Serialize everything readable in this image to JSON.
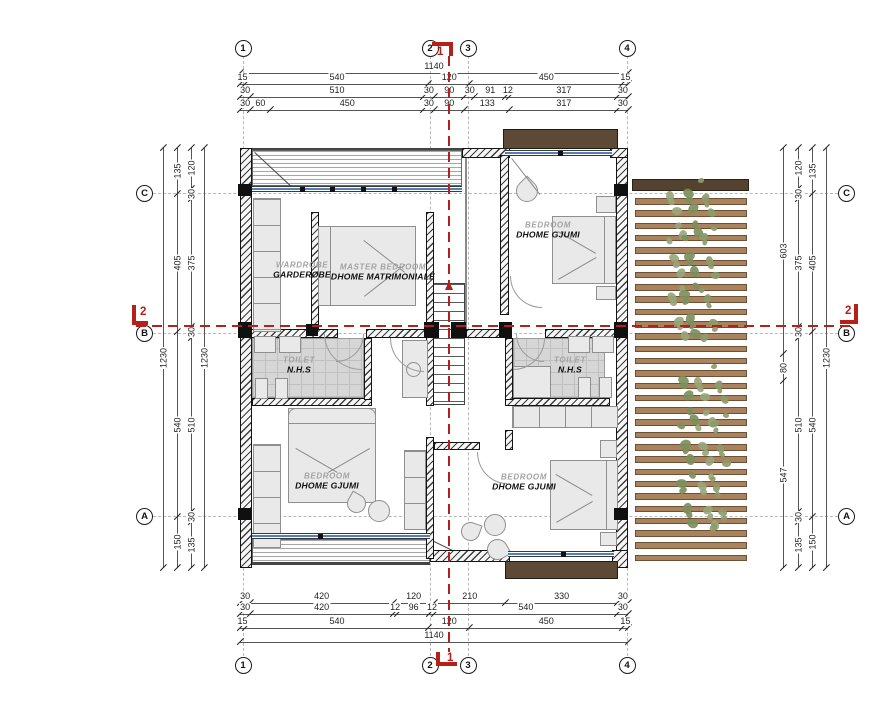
{
  "drawing": {
    "colors": {
      "section_red": "#b6201b",
      "window_blue": "#4f81bd",
      "balcony_brown": "#5d4a36",
      "slat_brown": "#a9835e",
      "slat_edge": "#6c5136",
      "pergola_bar": "#53422f",
      "leaf_green": "#8b9c6d",
      "wall_ink": "#141414",
      "dim_ink": "#1f1f1f",
      "label_gray": "#a3a3a3",
      "label_black": "#0f0f0f"
    },
    "grid": {
      "columns": [
        {
          "label": "1",
          "x": 243
        },
        {
          "label": "2",
          "x": 430
        },
        {
          "label": "3",
          "x": 468
        },
        {
          "label": "4",
          "x": 627
        }
      ],
      "rows": [
        {
          "label": "C",
          "y": 193
        },
        {
          "label": "B",
          "y": 333
        },
        {
          "label": "A",
          "y": 516
        }
      ]
    },
    "section_markers": {
      "vertical_label": "1",
      "horizontal_label": "2"
    },
    "dim_chains": [
      {
        "id": "top-total",
        "dir": "h",
        "y": 73,
        "x1": 240,
        "x2": 628,
        "segs": [
          1140
        ]
      },
      {
        "id": "top-row1",
        "dir": "h",
        "y": 84,
        "x1": 240,
        "x2": 628,
        "segs": [
          15,
          540,
          120,
          450,
          15
        ]
      },
      {
        "id": "top-row2",
        "dir": "h",
        "y": 97,
        "x1": 240,
        "x2": 628,
        "segs": [
          30,
          510,
          30,
          90,
          30,
          91,
          12,
          317,
          30
        ]
      },
      {
        "id": "top-row3",
        "dir": "h",
        "y": 110,
        "x1": 240,
        "x2": 628,
        "segs": [
          30,
          60,
          450,
          30,
          90,
          133,
          317,
          30
        ]
      },
      {
        "id": "bottom-row1",
        "dir": "h",
        "y": 603,
        "x1": 240,
        "x2": 628,
        "segs": [
          30,
          420,
          120,
          210,
          330,
          30
        ]
      },
      {
        "id": "bottom-row2",
        "dir": "h",
        "y": 614,
        "x1": 240,
        "x2": 628,
        "segs": [
          30,
          420,
          12,
          96,
          12,
          540,
          30
        ]
      },
      {
        "id": "bottom-row3",
        "dir": "h",
        "y": 628,
        "x1": 240,
        "x2": 628,
        "segs": [
          15,
          540,
          120,
          450,
          15
        ]
      },
      {
        "id": "bottom-total",
        "dir": "h",
        "y": 642,
        "x1": 240,
        "x2": 628,
        "segs": [
          1140
        ]
      },
      {
        "id": "left-total",
        "dir": "v",
        "x": 163,
        "y1": 148,
        "y2": 568,
        "segs": [
          1230
        ]
      },
      {
        "id": "left-row2",
        "dir": "v",
        "x": 177,
        "y1": 148,
        "y2": 568,
        "segs": [
          135,
          405,
          540,
          150
        ]
      },
      {
        "id": "left-row3",
        "dir": "v",
        "x": 191,
        "y1": 148,
        "y2": 568,
        "segs": [
          120,
          30,
          375,
          30,
          510,
          30,
          135
        ]
      },
      {
        "id": "left-inner",
        "dir": "v",
        "x": 204,
        "y1": 148,
        "y2": 568,
        "segs": [
          1230
        ]
      },
      {
        "id": "right-inner",
        "dir": "v",
        "x": 783,
        "y1": 148,
        "y2": 568,
        "segs": [
          603,
          80,
          547
        ]
      },
      {
        "id": "right-row2",
        "dir": "v",
        "x": 798,
        "y1": 148,
        "y2": 568,
        "segs": [
          120,
          30,
          375,
          30,
          510,
          30,
          135
        ]
      },
      {
        "id": "right-row3",
        "dir": "v",
        "x": 812,
        "y1": 148,
        "y2": 568,
        "segs": [
          135,
          405,
          540,
          150
        ]
      },
      {
        "id": "right-total",
        "dir": "v",
        "x": 826,
        "y1": 148,
        "y2": 568,
        "segs": [
          1230
        ]
      }
    ],
    "rooms": [
      {
        "en": "WARDROBE",
        "sq": "GARDEROBE",
        "x": 302,
        "y": 270
      },
      {
        "en": "MASTER BEDROOM",
        "sq": "DHOME MATRIMONIALE",
        "x": 383,
        "y": 272
      },
      {
        "en": "BEDROOM",
        "sq": "DHOME GJUMI",
        "x": 548,
        "y": 230
      },
      {
        "en": "TOILET",
        "sq": "N.H.S",
        "x": 299,
        "y": 365
      },
      {
        "en": "TOILET",
        "sq": "N.H.S",
        "x": 570,
        "y": 365
      },
      {
        "en": "BEDROOM",
        "sq": "DHOME GJUMI",
        "x": 327,
        "y": 481
      },
      {
        "en": "BEDROOM",
        "sq": "DHOME GJUMI",
        "x": 524,
        "y": 482
      }
    ]
  }
}
